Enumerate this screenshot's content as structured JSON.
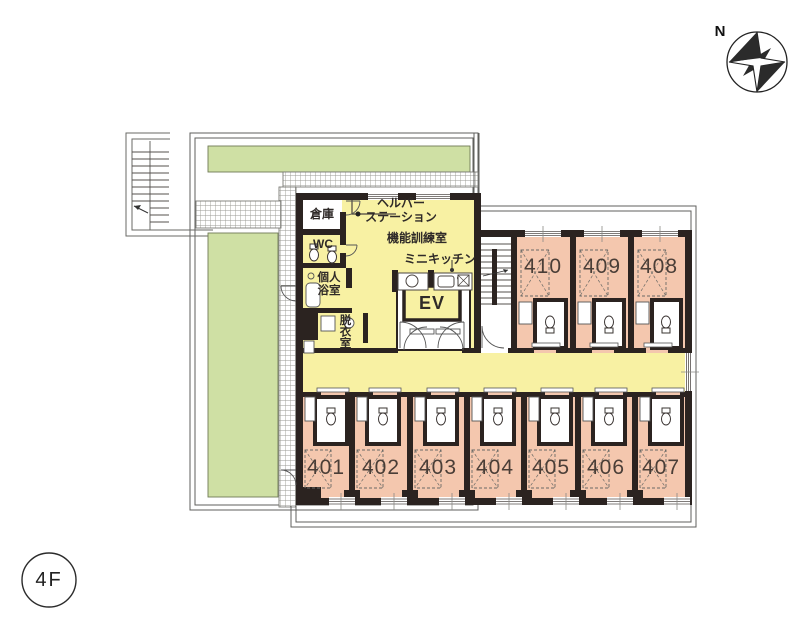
{
  "floor_badge": {
    "label": "4F"
  },
  "compass": {
    "label": "N"
  },
  "common_area": {
    "storage": "倉庫",
    "helper_station_line1": "ヘルパー",
    "helper_station_line2": "ステーション",
    "training_room": "機能訓練室",
    "wc": "WC",
    "mini_kitchen": "ミニキッチン",
    "private_bath_line1": "個人",
    "private_bath_line2": "浴室",
    "dressing_room": "脱衣室",
    "elevator": "EV"
  },
  "rooms_top": [
    {
      "number": "410"
    },
    {
      "number": "409"
    },
    {
      "number": "408"
    }
  ],
  "rooms_bottom": [
    {
      "number": "401"
    },
    {
      "number": "402"
    },
    {
      "number": "403"
    },
    {
      "number": "404"
    },
    {
      "number": "405"
    },
    {
      "number": "406"
    },
    {
      "number": "407"
    }
  ],
  "colors": {
    "garden_green": "#cfe0a4",
    "common_yellow": "#f8f1a3",
    "room_pink": "#f4c7ae",
    "wall_dark": "#2b2320"
  }
}
